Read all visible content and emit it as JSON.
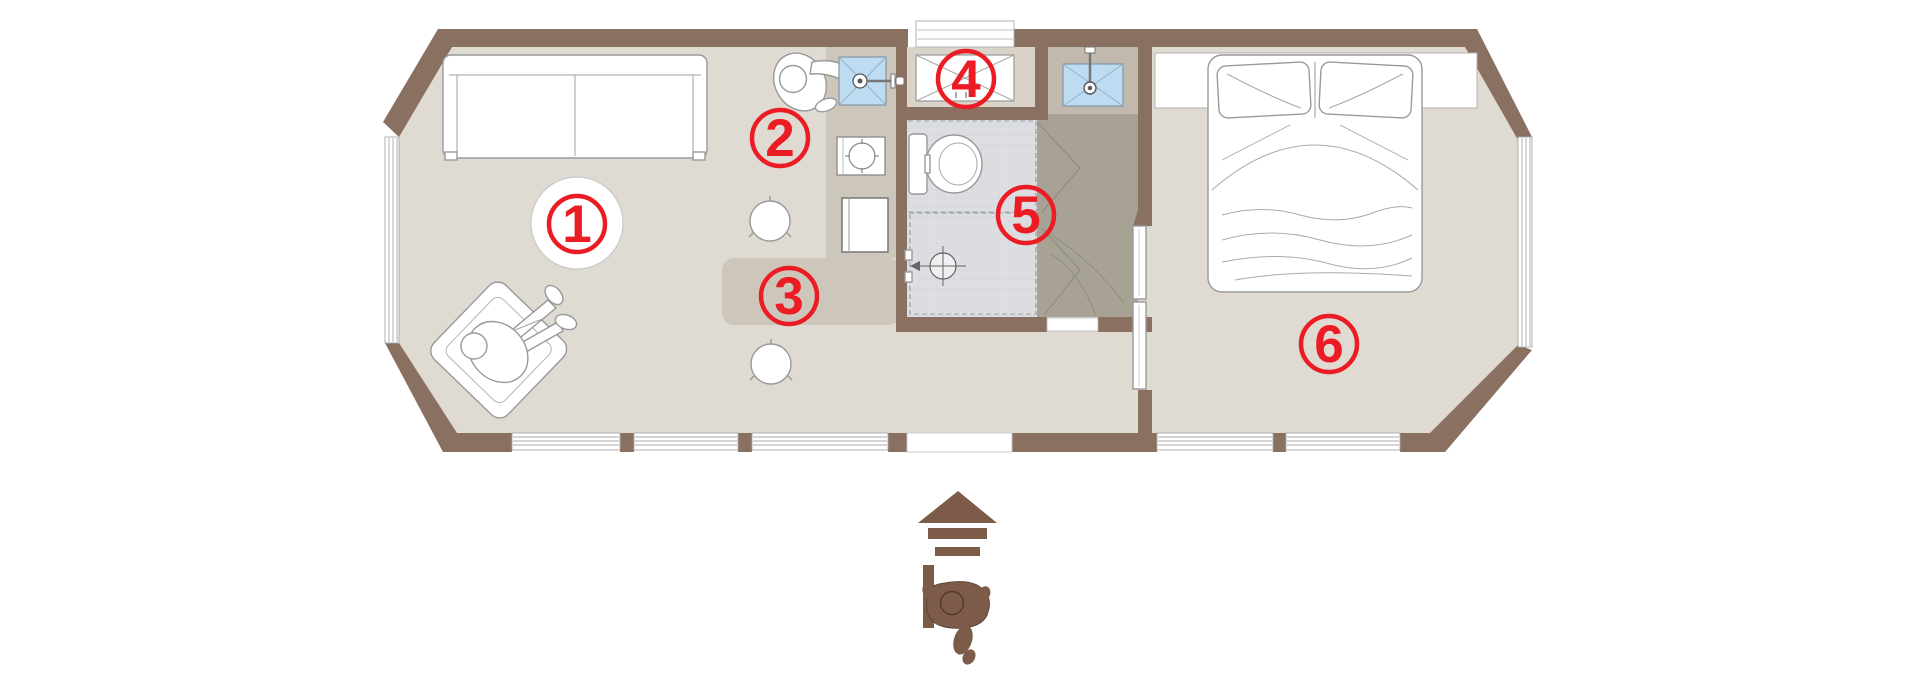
{
  "title": "Tiny house floor plan",
  "markers": [
    {
      "label": "1"
    },
    {
      "label": "2"
    },
    {
      "label": "3"
    },
    {
      "label": "4"
    },
    {
      "label": "5"
    },
    {
      "label": "6"
    }
  ],
  "palette": {
    "background": "#ffffff",
    "wall_brown": "#8a7060",
    "floor": "#dfdbd3",
    "kitchen_strip": "#cdc7bb",
    "vent_alcove": "#d9d3c8",
    "vestibule": "#c1b9ad",
    "hallway": "#a8a294",
    "bathroom_floor": "#dcdee1",
    "sink_blue": "#bddcf2",
    "marker_red": "#ec1c24",
    "entrance_brown": "#7d5b49",
    "furniture_outline": "#999999"
  }
}
